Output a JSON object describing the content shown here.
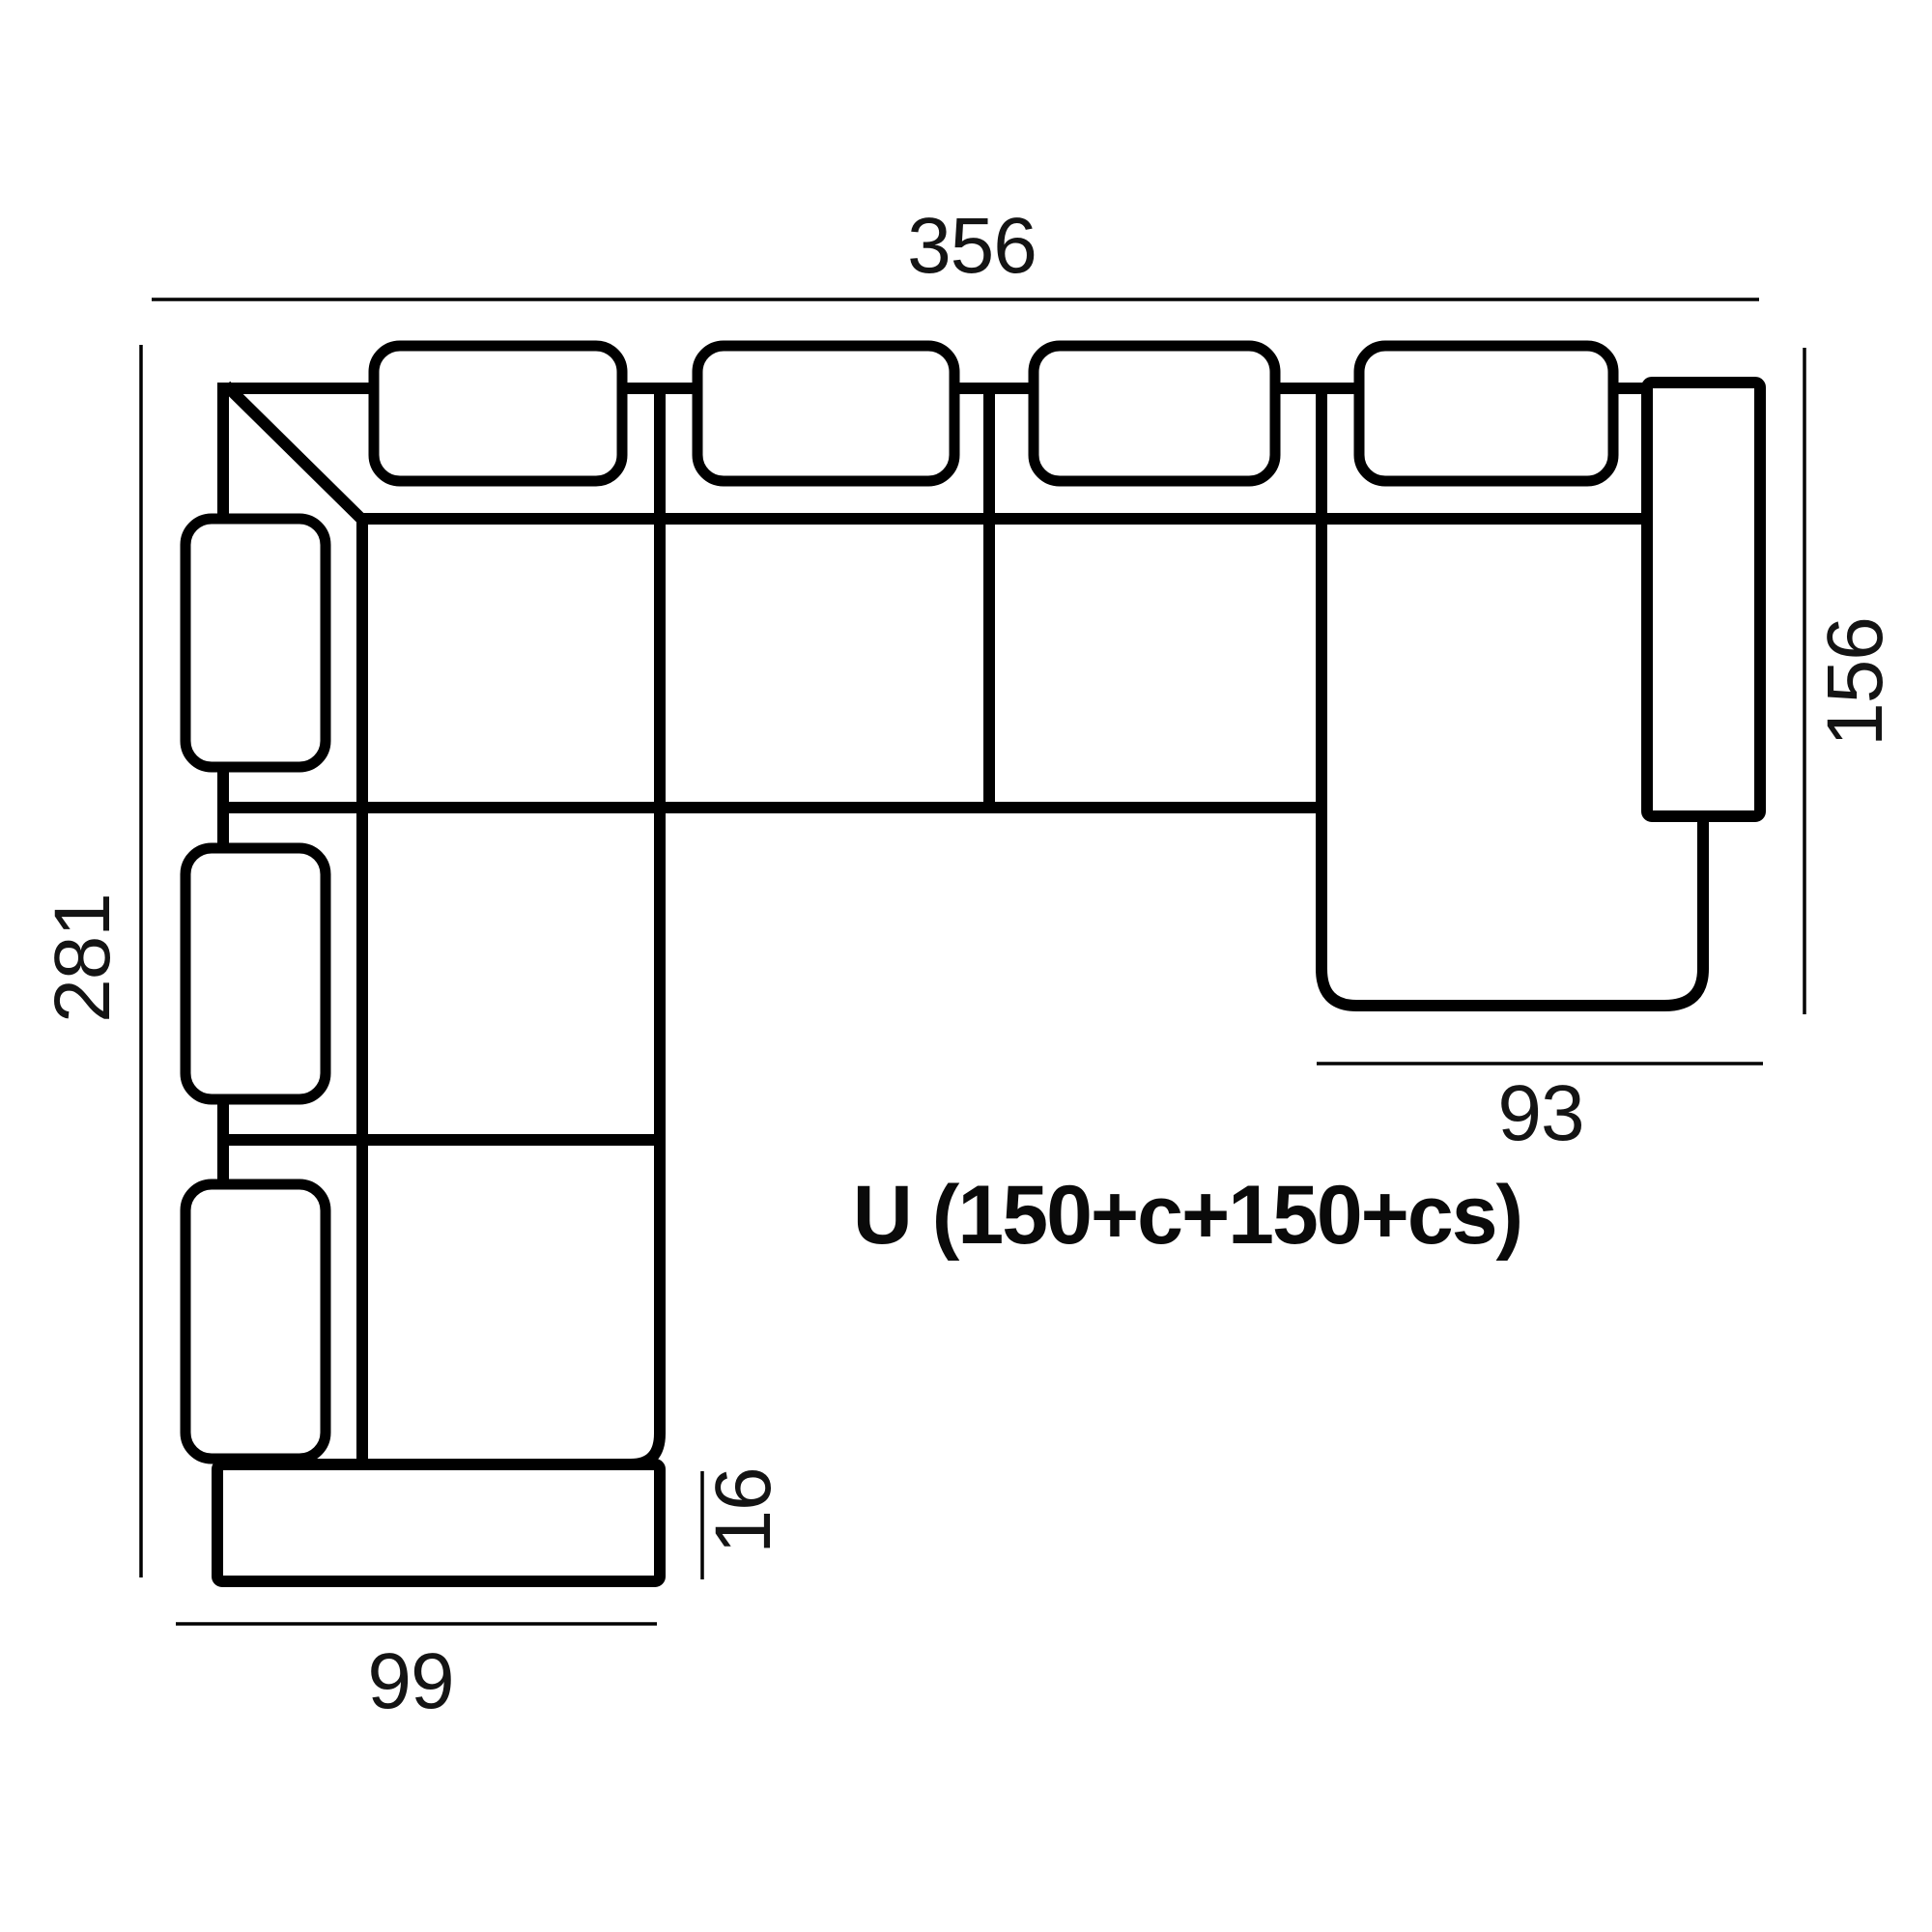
{
  "diagram": {
    "type": "sofa-top-view-dimension-drawing",
    "product_label": "U (150+c+150+cs)",
    "dimensions": {
      "total_width_top": "356",
      "total_depth_left": "281",
      "chaise_depth_right": "156",
      "chaise_width_bottom": "93",
      "left_wing_width_bottom": "99",
      "armrest_thickness": "16"
    },
    "colors": {
      "line": "#000000",
      "text": "#141414",
      "background": "#ffffff"
    }
  }
}
